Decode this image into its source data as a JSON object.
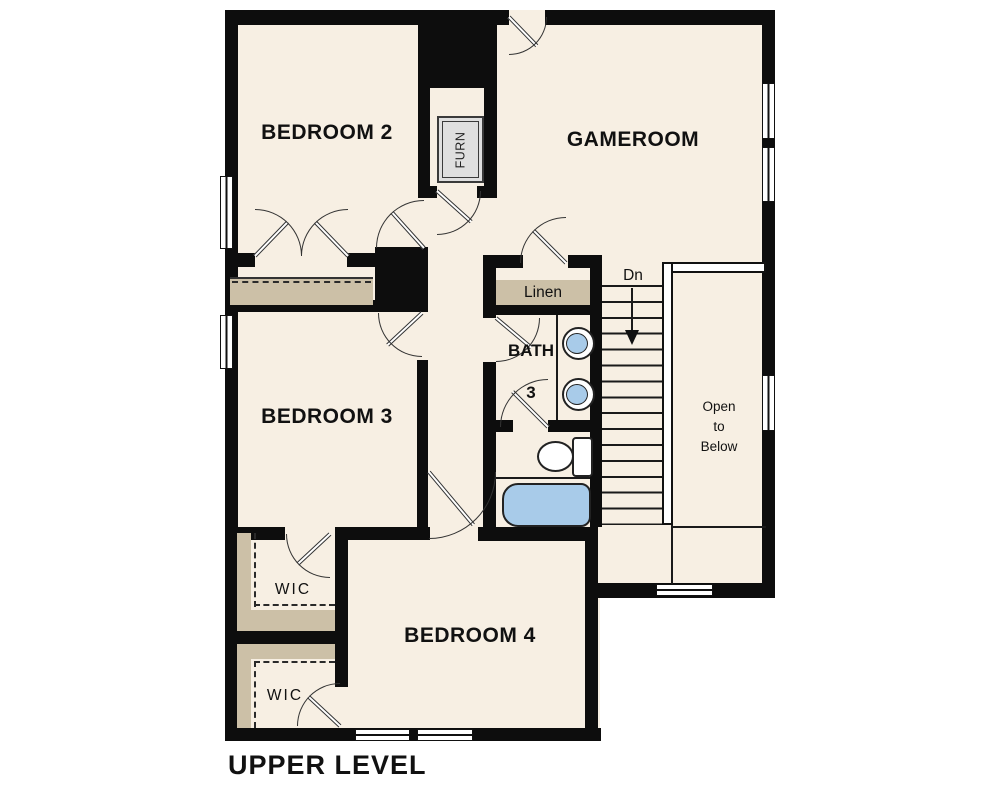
{
  "plan": {
    "title": "UPPER LEVEL",
    "rooms": {
      "bedroom2": "BEDROOM 2",
      "gameroom": "GAMEROOM",
      "bedroom3": "BEDROOM 3",
      "bedroom4": "BEDROOM 4",
      "bath3": {
        "line1": "BATH",
        "line2": "3"
      },
      "linen": "Linen",
      "wic1": "WIC",
      "wic2": "WIC",
      "furnace": "FURN",
      "stairs_direction": "Dn",
      "open_to_below": {
        "line1": "Open",
        "line2": "to",
        "line3": "Below"
      }
    },
    "colors": {
      "floor": "#F7EFE3",
      "wall": "#0d0d0d",
      "shelf": "#CCC0A7",
      "fixture_blue": "#A8CBE9",
      "furn_fill": "#DFDFDF"
    }
  }
}
